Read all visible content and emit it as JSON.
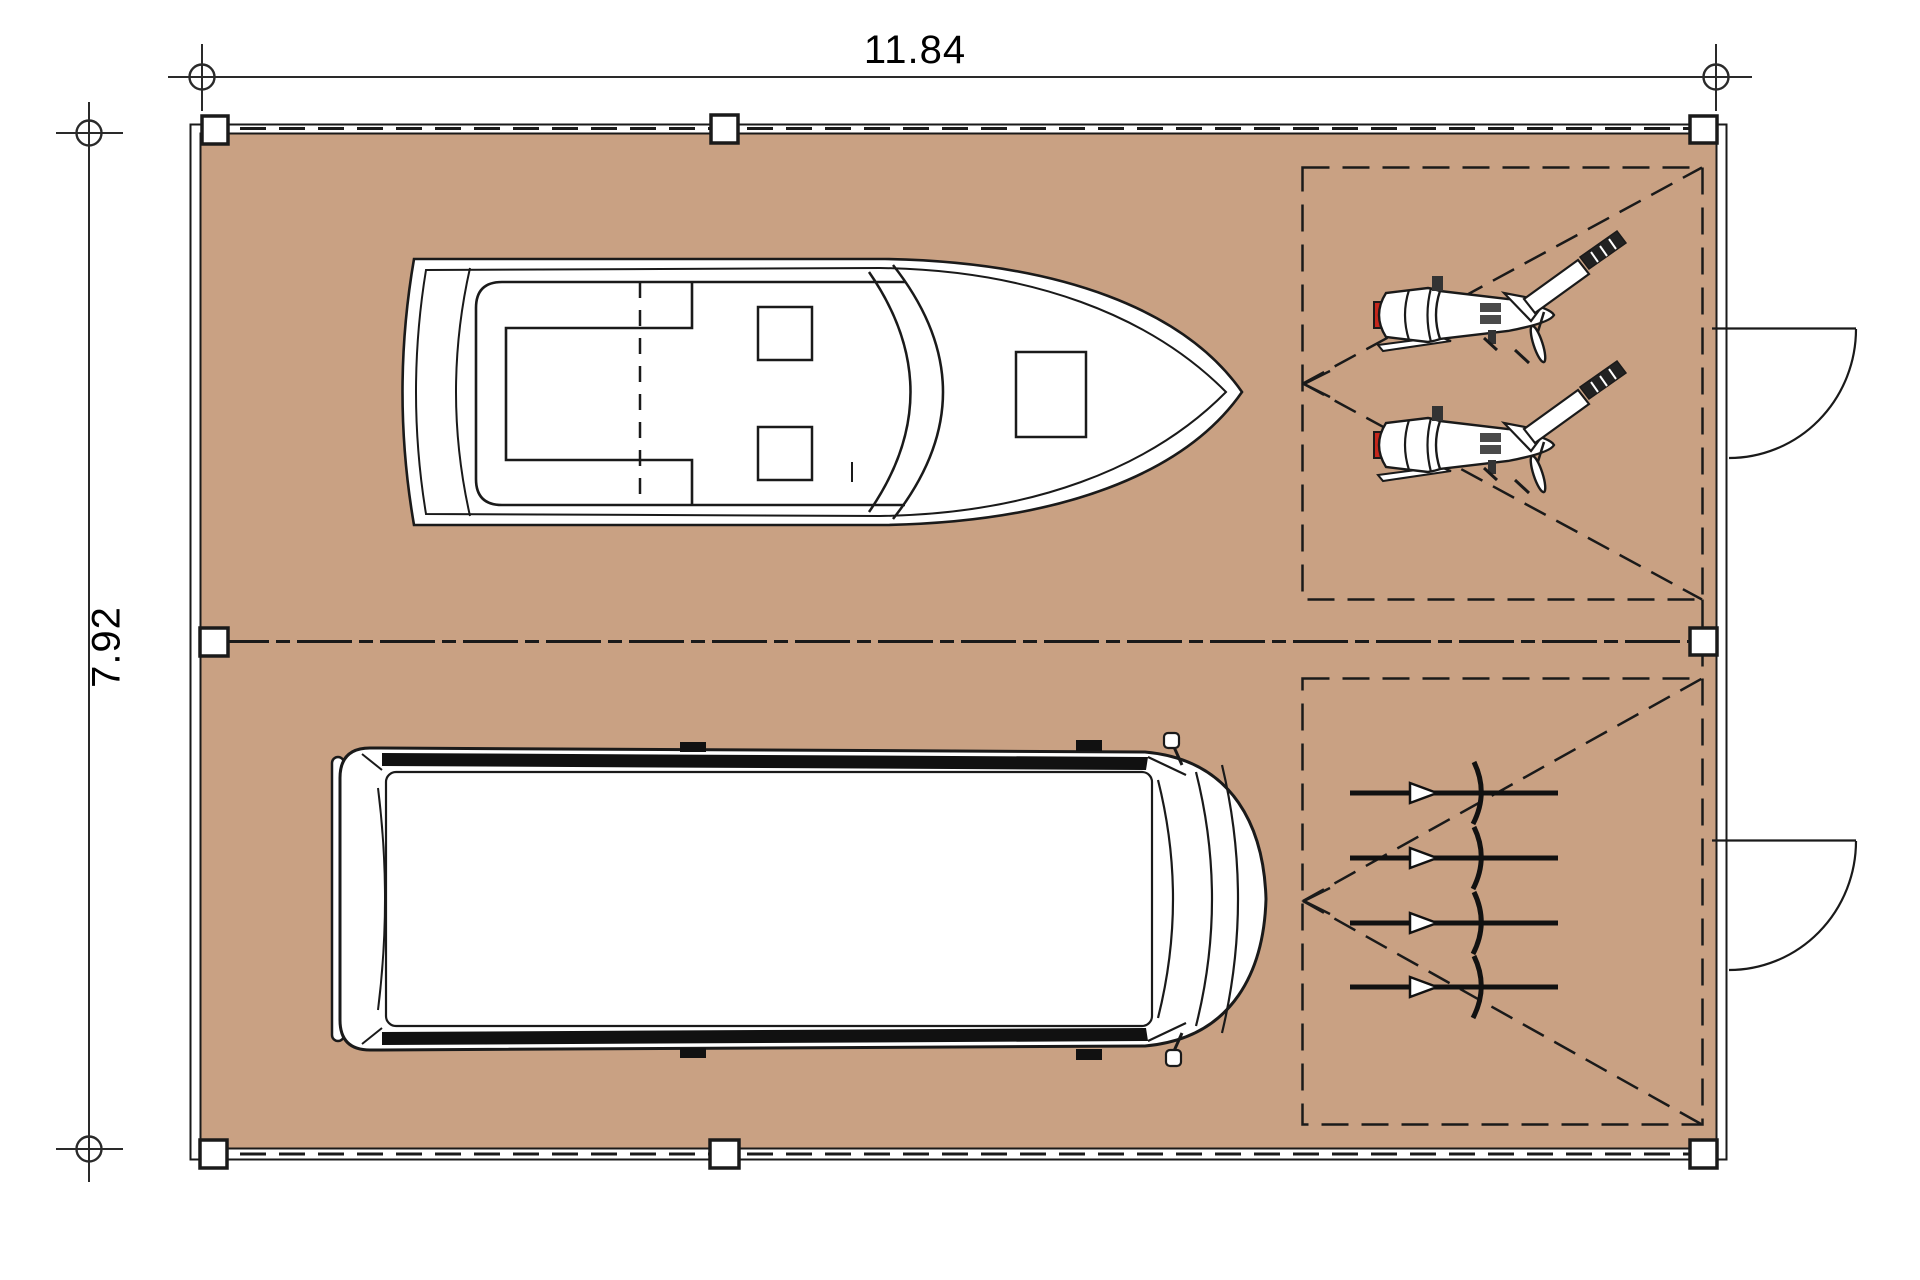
{
  "page": {
    "type": "architectural floor plan (top view)",
    "background": "#ffffff"
  },
  "dimensions": {
    "width_label": "11.84",
    "height_label": "7.92"
  },
  "colors": {
    "floor": "#c9a183",
    "line": "#1a1a1a",
    "dimension_line": "#2a2a2a",
    "motorcycle_tail_light": "#c4271c",
    "vehicle_fill": "#ffffff"
  },
  "structure": {
    "posts_count": 8,
    "doors_on_right_wall": 2,
    "dashed_storage_zones": 2
  },
  "vehicles": {
    "boat_count": 1,
    "van_count": 1,
    "motorcycle_count": 2,
    "bicycle_count": 4
  }
}
